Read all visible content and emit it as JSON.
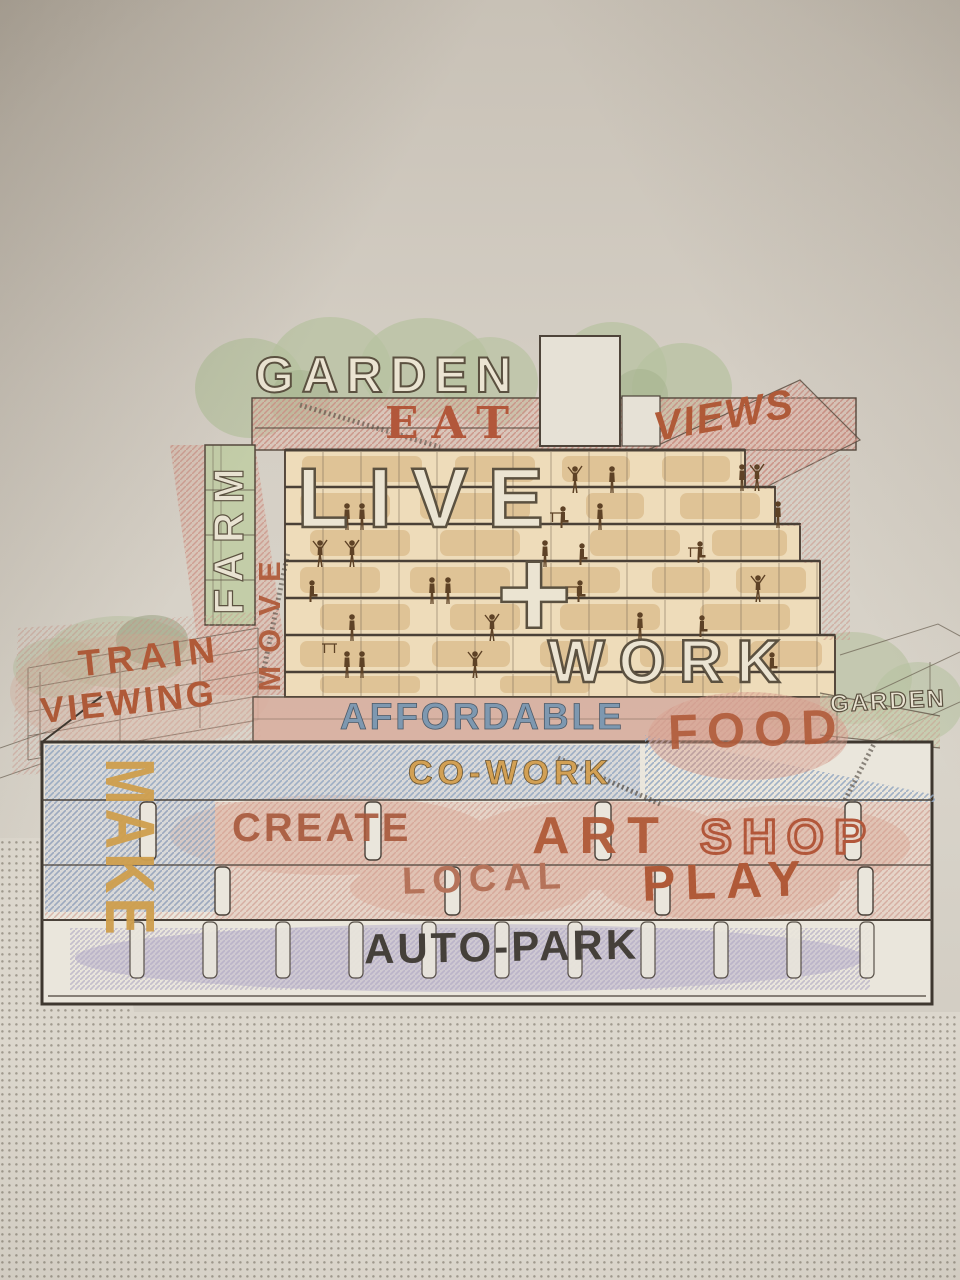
{
  "poster": {
    "description": "Architectural cross-section program diagram of a mixed-use building",
    "labels": {
      "garden_roof": "GARDEN",
      "eat": "EAT",
      "views": "VIEWS",
      "farm": "FARM",
      "move": "MOVE",
      "live": "LIVE",
      "plus": "+",
      "work": "WORK",
      "train_line1": "TRAIN",
      "train_line2": "VIEWING",
      "affordable": "AFFORDABLE",
      "food": "FOOD",
      "garden_terrace": "GARDEN",
      "make": "MAKE",
      "cowork": "CO-WORK",
      "create": "CREATE",
      "art": "ART",
      "shop": "SHOP",
      "local": "LOCAL",
      "play": "PLAY",
      "autopark": "AUTO-PARK"
    },
    "colors": {
      "rust": "#b05a38",
      "cream": "#ebe4d2",
      "sage_green": "#b7c2a0",
      "slate_blue": "#7e98b0",
      "gold": "#cf9f4d",
      "lavender": "#b0a6c6",
      "salmon_pink": "#d9a28f",
      "charcoal": "#45403a",
      "tan": "#eedcba",
      "wall_beige": "#d4cec4"
    }
  }
}
